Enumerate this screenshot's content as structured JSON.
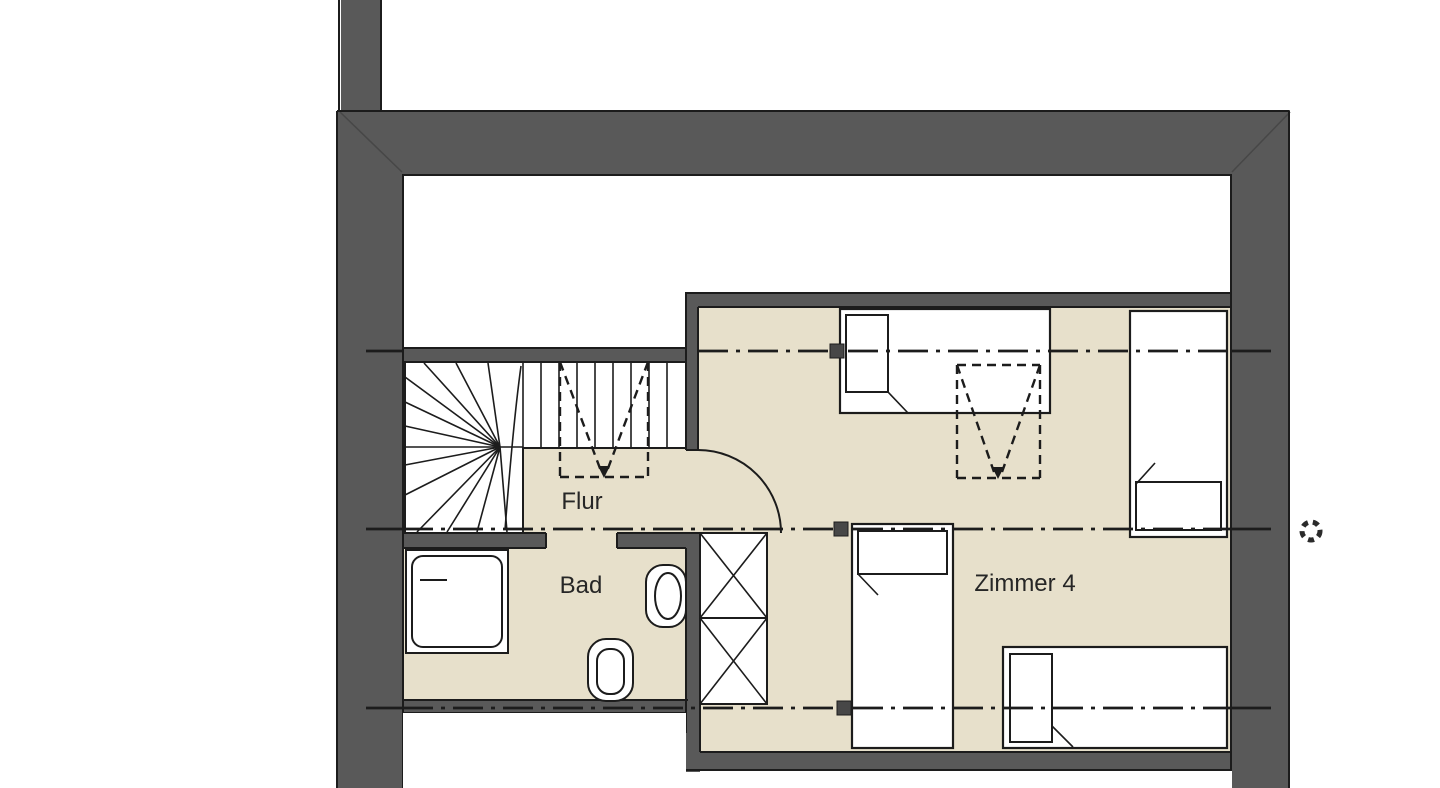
{
  "colors": {
    "wall": "#595959",
    "floor": "#e7e0cb",
    "paper": "#ffffff",
    "line": "#1c1c1c",
    "seam": "#474747",
    "text": "#262626"
  },
  "rooms": {
    "flur": {
      "label": "Flur"
    },
    "bad": {
      "label": "Bad"
    },
    "zimmer4": {
      "label": "Zimmer 4"
    }
  },
  "symbols": {
    "skylight_marker": "dashed-rect-with-v",
    "section_marker": "filled-square",
    "survey_marker": "dashed-circle",
    "door_swing": "quarter-arc",
    "wardrobe": "x-crossed-box"
  }
}
